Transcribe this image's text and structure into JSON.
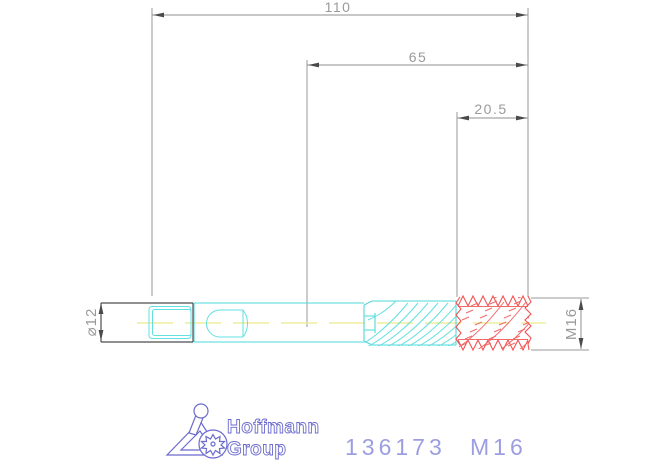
{
  "dimensions": {
    "overall_length": "110",
    "flute_length": "65",
    "thread_length": "20.5",
    "shank_diameter": "⌀12",
    "thread_designation": "M16"
  },
  "branding": {
    "name_line1": "Hoffmann",
    "name_line2": "Group"
  },
  "footer": {
    "article_number": "136173",
    "size": "M16"
  },
  "icons": {
    "logo_mark": "hoffmann-person-gear-logo"
  },
  "colors": {
    "tool_outline_cyan": "#4FD9D9",
    "thread_red": "#F05454",
    "centerline_yellow": "#EDED9C",
    "dimension_gray": "#8F8F8F",
    "dimension_text_gray": "#9A9A9A",
    "shank_end_dark": "#4D4D4D",
    "logo_blue": "#6B6BCE",
    "article_text_blue": "#9C9EE0"
  }
}
